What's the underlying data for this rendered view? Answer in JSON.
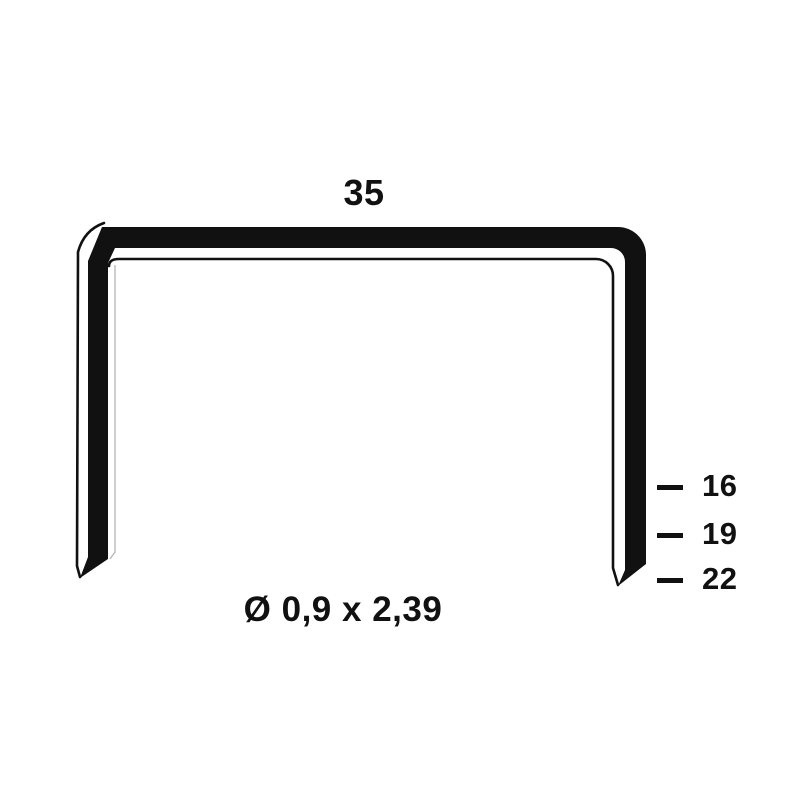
{
  "diagram": {
    "subject": "staple-dimension-drawing",
    "crown_width_label": "35",
    "wire_spec_label": "Ø 0,9 x 2,39",
    "leg_lengths": [
      {
        "label": "16"
      },
      {
        "label": "19"
      },
      {
        "label": "22"
      }
    ],
    "colors": {
      "ink": "#111111",
      "background": "#ffffff",
      "faint_line": "#b5b5b5"
    }
  }
}
